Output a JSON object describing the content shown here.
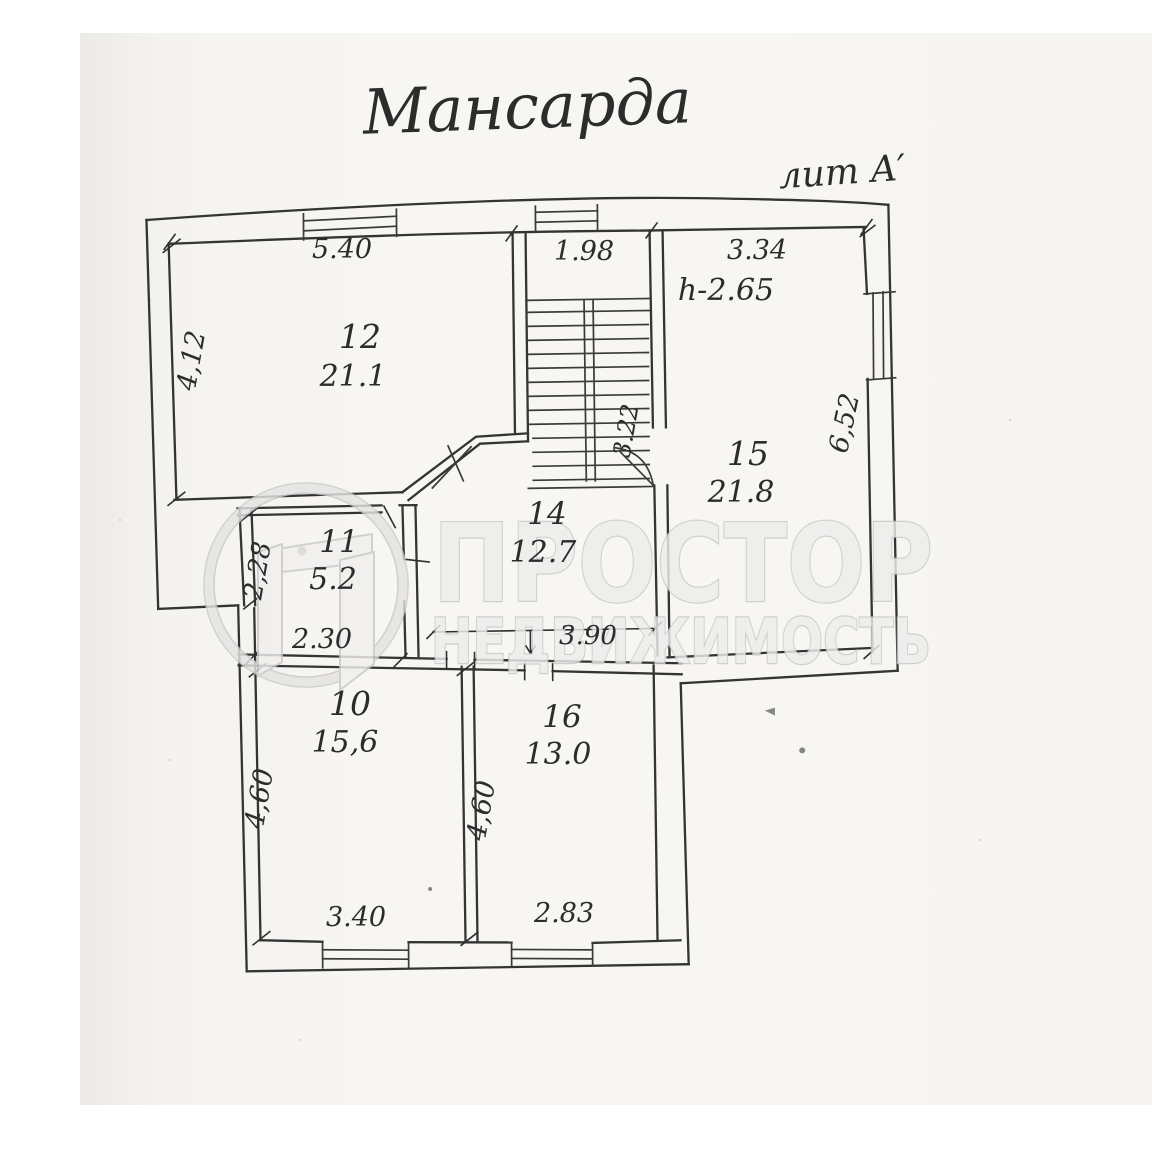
{
  "scan": {
    "title": "Мансарда",
    "litera": "лит А′",
    "height_note": "h-2.65"
  },
  "watermark": {
    "brand_line1": "ПРОСТОР",
    "brand_line2": "НЕДВИЖИМОСТЬ"
  },
  "rooms": [
    {
      "number": "12",
      "area": "21.1"
    },
    {
      "number": "15",
      "area": "21.8"
    },
    {
      "number": "14",
      "area": "12.7"
    },
    {
      "number": "11",
      "area": "5.2"
    },
    {
      "number": "10",
      "area": "15,6"
    },
    {
      "number": "16",
      "area": "13.0"
    }
  ],
  "dims": {
    "room12_width": "5.40",
    "corridor_width": "1.98",
    "room15_width": "3.34",
    "room12_depth": "4,12",
    "room15_depth": "6,52",
    "stair_depth": "3.22",
    "room11_depth": "2,28",
    "room11_width": "2.30",
    "hall_width": "3.90",
    "room10_depth": "4,60",
    "room16_depth": "4,60",
    "room10_width": "3.40",
    "room16_width": "2.83"
  }
}
